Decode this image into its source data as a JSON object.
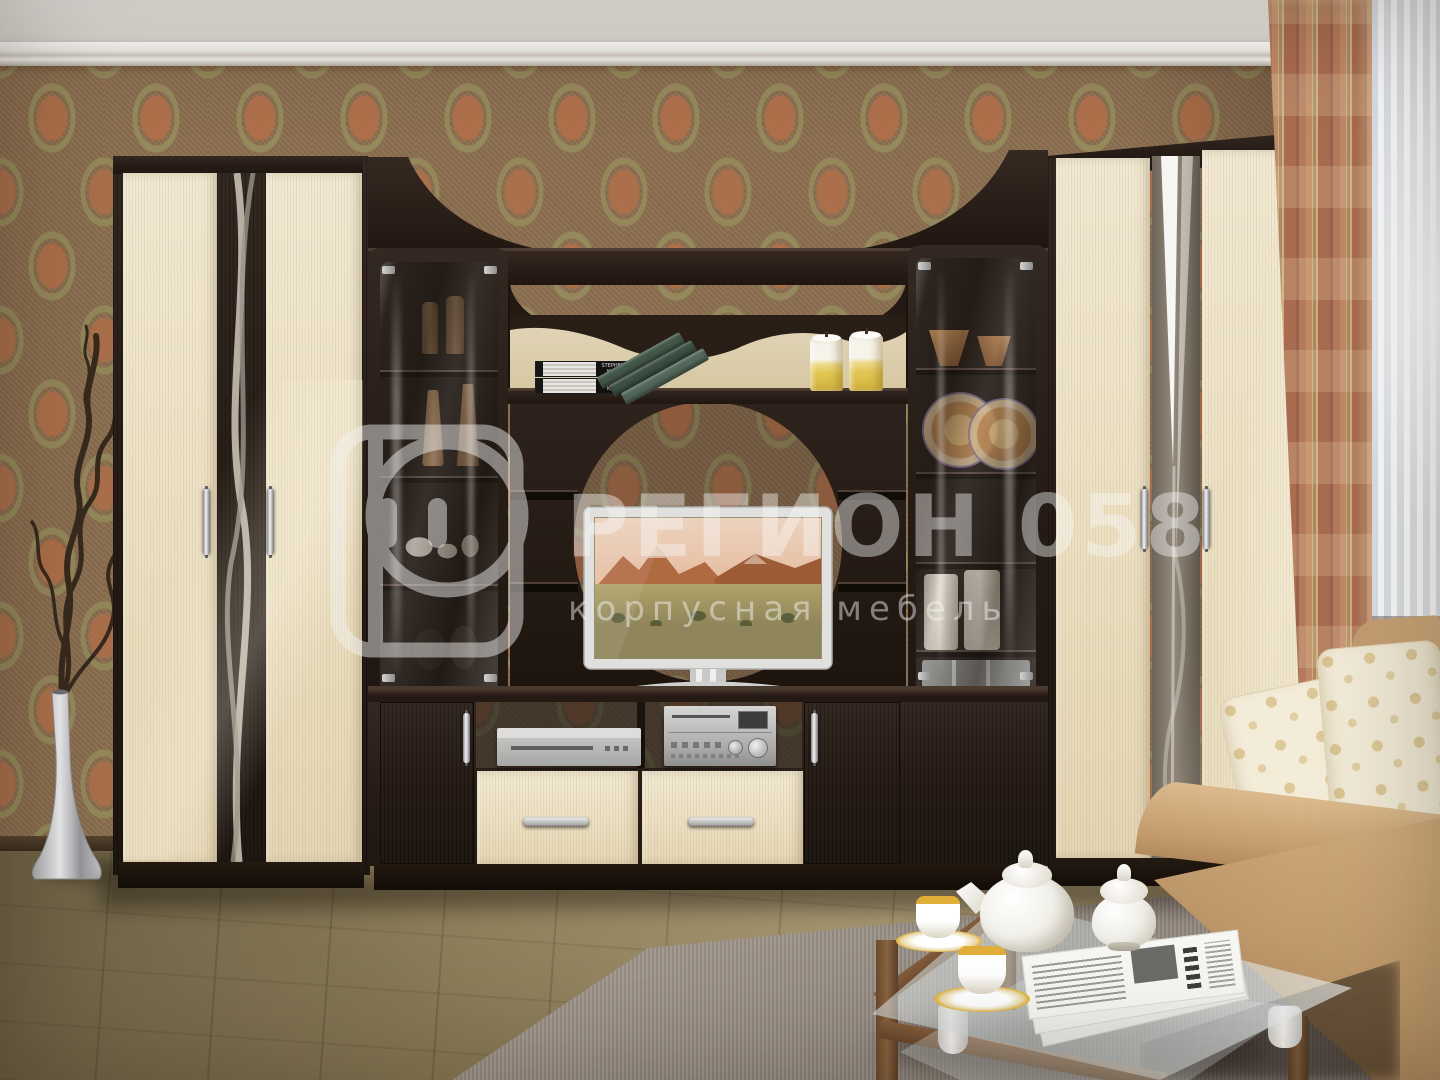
{
  "scene": "living room furniture wall unit product photo",
  "watermark": {
    "logo_letter": "Р",
    "title": "РЕГИОН 058",
    "subtitle": "корпусная мебель",
    "color": "#f5f5f5"
  },
  "books": {
    "spine_top": "STEPHEN KING",
    "spine_bottom": "STEPHEN KING"
  },
  "palette": {
    "wall_base": "#8a6e50",
    "wall_accent": "#b2704a",
    "wall_olive": "#968e5e",
    "furniture_dark": "#261c15",
    "furniture_cream": "#ece0c4",
    "floor": "#8c7c59",
    "rug": "#9d938a",
    "sofa": "#c9a376",
    "drape": "#b57a5e",
    "sheer": "#f2f4f5",
    "candle_yellow": "#e2c654",
    "chrome": "#d9d9d7",
    "tv_frame": "#e0e0de"
  }
}
